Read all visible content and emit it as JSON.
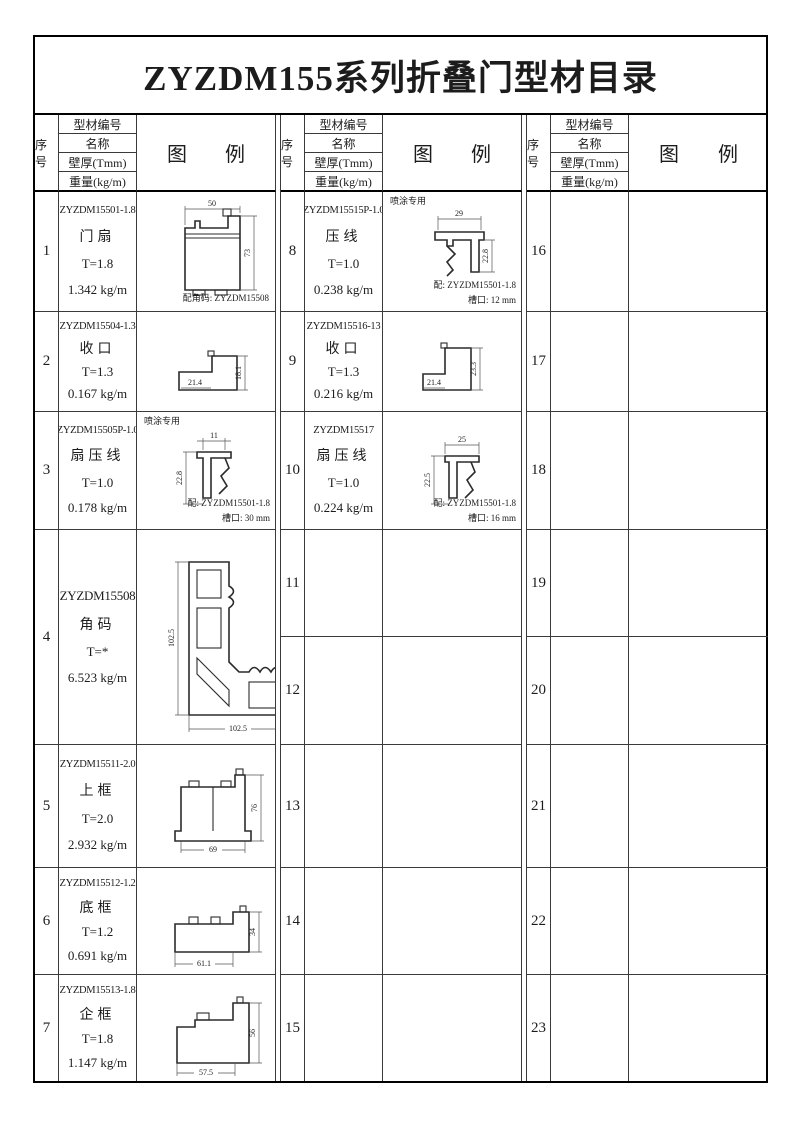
{
  "page": {
    "title": "ZYZDM155系列折叠门型材目录"
  },
  "header": {
    "seq": "序号",
    "info_rows": [
      "型材编号",
      "名称",
      "壁厚(Tmm)",
      "重量(kg/m)"
    ],
    "legend": [
      "图",
      "例"
    ]
  },
  "rows": {
    "r1": {
      "seq": "1",
      "code": "ZYZDM15501-1.8",
      "name": "门扇",
      "thick": "T=1.8",
      "weight": "1.342 kg/m",
      "fig": {
        "dim_top": "50",
        "dim_right": "73",
        "note": "配角码: ZYZDM15508"
      }
    },
    "r2": {
      "seq": "2",
      "code": "ZYZDM15504-1.3",
      "name": "收口",
      "thick": "T=1.3",
      "weight": "0.167 kg/m",
      "fig": {
        "dim_w": "21.4",
        "dim_h": "18.1"
      }
    },
    "r3": {
      "seq": "3",
      "code": "ZYZDM15505P-1.0",
      "name": "扇压线",
      "thick": "T=1.0",
      "weight": "0.178 kg/m",
      "fig": {
        "special": "喷涂专用",
        "dim_top": "11",
        "dim_left": "22.8",
        "note1": "配: ZYZDM15501-1.8",
        "note2": "槽口: 30 mm"
      }
    },
    "r4": {
      "seq": "4",
      "code": "ZYZDM15508",
      "name": "角码",
      "thick": "T=*",
      "weight": "6.523 kg/m",
      "fig": {
        "dim_left": "102.5",
        "dim_bottom": "102.5",
        "dim_right": "41"
      }
    },
    "r5": {
      "seq": "5",
      "code": "ZYZDM15511-2.0",
      "name": "上框",
      "thick": "T=2.0",
      "weight": "2.932 kg/m",
      "fig": {
        "dim_bottom": "69",
        "dim_right": "76"
      }
    },
    "r6": {
      "seq": "6",
      "code": "ZYZDM15512-1.2",
      "name": "底框",
      "thick": "T=1.2",
      "weight": "0.691 kg/m",
      "fig": {
        "dim_bottom": "61.1",
        "dim_right": "34"
      }
    },
    "r7": {
      "seq": "7",
      "code": "ZYZDM15513-1.8",
      "name": "企框",
      "thick": "T=1.8",
      "weight": "1.147 kg/m",
      "fig": {
        "dim_bottom": "57.5",
        "dim_right": "56"
      }
    },
    "r8": {
      "seq": "8",
      "code": "ZYZDM15515P-1.0",
      "name": "压线",
      "thick": "T=1.0",
      "weight": "0.238 kg/m",
      "fig": {
        "special": "喷涂专用",
        "dim_top": "29",
        "dim_right": "22.8",
        "note1": "配: ZYZDM15501-1.8",
        "note2": "槽口: 12 mm"
      }
    },
    "r9": {
      "seq": "9",
      "code": "ZYZDM15516-13",
      "name": "收口",
      "thick": "T=1.3",
      "weight": "0.216 kg/m",
      "fig": {
        "dim_w": "21.4",
        "dim_h": "23.3"
      }
    },
    "r10": {
      "seq": "10",
      "code": "ZYZDM15517",
      "name": "扇压线",
      "thick": "T=1.0",
      "weight": "0.224 kg/m",
      "fig": {
        "dim_top": "25",
        "dim_left": "22.5",
        "note1": "配: ZYZDM15501-1.8",
        "note2": "槽口: 16 mm"
      }
    },
    "r11": {
      "seq": "11"
    },
    "r12": {
      "seq": "12"
    },
    "r13": {
      "seq": "13"
    },
    "r14": {
      "seq": "14"
    },
    "r15": {
      "seq": "15"
    },
    "r16": {
      "seq": "16"
    },
    "r17": {
      "seq": "17"
    },
    "r18": {
      "seq": "18"
    },
    "r19": {
      "seq": "19"
    },
    "r20": {
      "seq": "20"
    },
    "r21": {
      "seq": "21"
    },
    "r22": {
      "seq": "22"
    },
    "r23": {
      "seq": "23"
    }
  }
}
